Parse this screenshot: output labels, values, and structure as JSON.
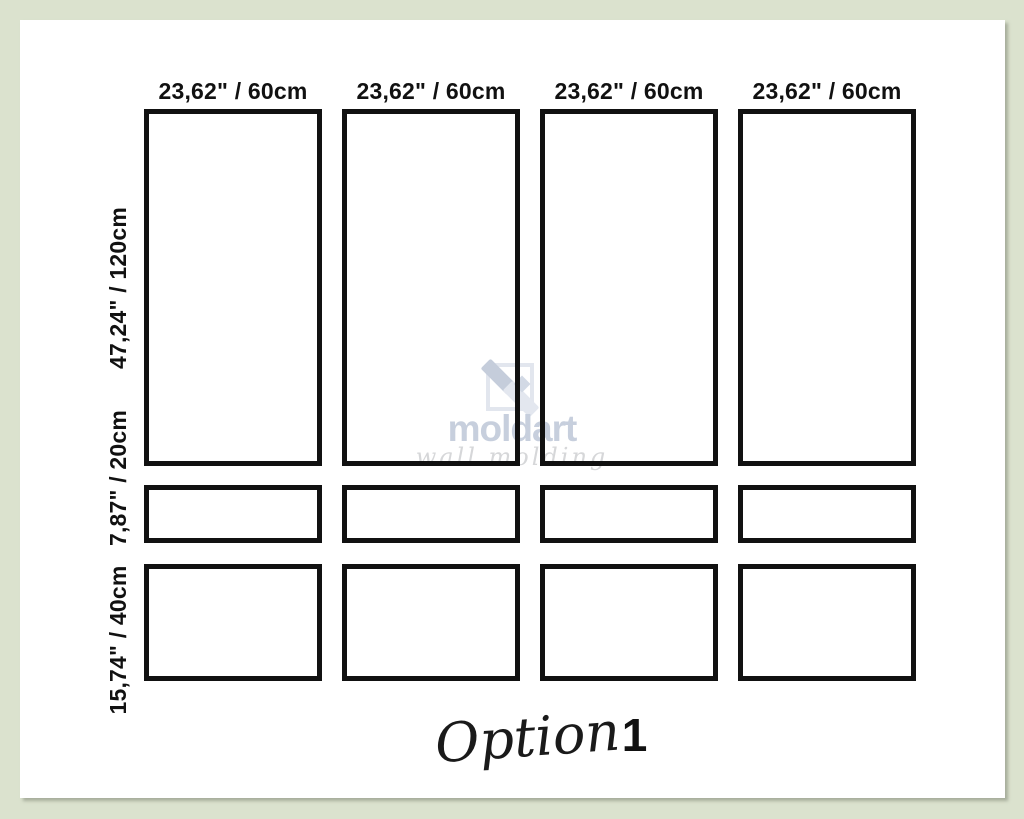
{
  "colors": {
    "frame_green": "#dbe2ce",
    "canvas_white": "#ffffff",
    "panel_line": "#111111",
    "watermark_blue_gray": "#c7cfdd",
    "watermark_script_gray": "#d6d7d9",
    "footer_black": "#1a1a1a"
  },
  "diagram": {
    "column_labels": [
      "23,62\" / 60cm",
      "23,62\" / 60cm",
      "23,62\" / 60cm",
      "23,62\" / 60cm"
    ],
    "row_labels": [
      "47,24\" / 120cm",
      "7,87\" / 20cm",
      "15,74\" / 40cm"
    ],
    "grid": {
      "columns": 4,
      "rows": 3
    }
  },
  "watermark": {
    "brand": "moldart",
    "tagline": "wall molding"
  },
  "footer": {
    "label": "Option",
    "number": "1"
  }
}
